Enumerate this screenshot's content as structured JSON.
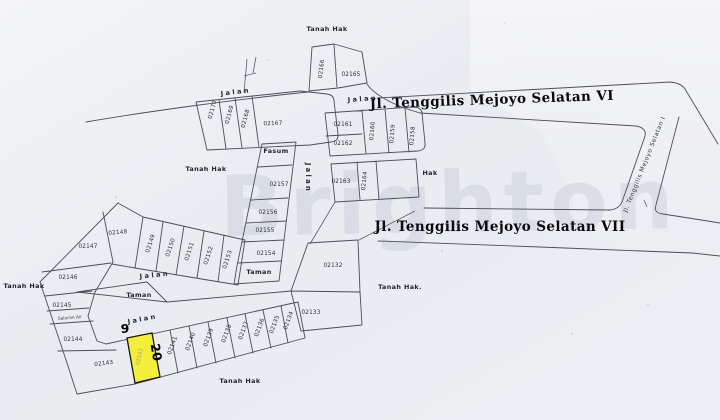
{
  "map": {
    "kind": "cadastral-parcel-map",
    "watermark": "Brighton",
    "highlight": {
      "parcel": "02142",
      "frontage": "9",
      "depth": "20",
      "fill": "#f3ee3b"
    },
    "streets": {
      "selatan_vi": "Jl. Tenggilis Mejoyo Selatan VI",
      "selatan_vii": "Jl. Tenggilis Mejoyo Selatan VII",
      "selatan_i": "Jl. Tenggilis Mejoyo Selatan I"
    },
    "labels": [
      {
        "t": "Jl. Tenggilis Mejoyo Selatan VI",
        "x": 492,
        "y": 104,
        "r": -2,
        "c": "street"
      },
      {
        "t": "Jl. Tenggilis Mejoyo Selatan VII",
        "x": 500,
        "y": 231,
        "r": 0,
        "c": "street"
      },
      {
        "t": "Jl. Tenggilis Mejoyo Selatan I",
        "x": 646,
        "y": 165,
        "r": -68,
        "c": "street-sm"
      },
      {
        "t": "Jalan",
        "x": 236,
        "y": 94,
        "r": -7,
        "c": "road"
      },
      {
        "t": "Jalan",
        "x": 363,
        "y": 101,
        "r": -4,
        "c": "road"
      },
      {
        "t": "Jalan",
        "x": 306,
        "y": 178,
        "r": 90,
        "c": "road"
      },
      {
        "t": "Jalan",
        "x": 155,
        "y": 277,
        "r": -6,
        "c": "road"
      },
      {
        "t": "Jalan",
        "x": 143,
        "y": 321,
        "r": -11,
        "c": "road"
      },
      {
        "t": "Tanah Hak",
        "x": 327,
        "y": 31,
        "r": 0,
        "c": "area"
      },
      {
        "t": "Tanah Hak",
        "x": 206,
        "y": 171,
        "r": 0,
        "c": "area"
      },
      {
        "t": "Tanah Hak",
        "x": 24,
        "y": 288,
        "r": 0,
        "c": "area"
      },
      {
        "t": "Tanah Hak",
        "x": 240,
        "y": 383,
        "r": 0,
        "c": "area"
      },
      {
        "t": "Tanah Hak.",
        "x": 400,
        "y": 289,
        "r": 0,
        "c": "area"
      },
      {
        "t": "Hak",
        "x": 430,
        "y": 175,
        "r": 0,
        "c": "area"
      },
      {
        "t": "Taman",
        "x": 259,
        "y": 274,
        "r": 0,
        "c": "area"
      },
      {
        "t": "Taman",
        "x": 139,
        "y": 297,
        "r": 0,
        "c": "area"
      },
      {
        "t": "Fasum",
        "x": 276,
        "y": 153,
        "r": 0,
        "c": "area"
      },
      {
        "t": "Saluran Air",
        "x": 70,
        "y": 319,
        "r": -4,
        "c": "tiny"
      },
      {
        "t": "02165",
        "x": 351,
        "y": 76,
        "r": 0,
        "c": "parcel"
      },
      {
        "t": "02166",
        "x": 323,
        "y": 69,
        "r": -83,
        "c": "parcel"
      },
      {
        "t": "02170",
        "x": 214,
        "y": 110,
        "r": -75,
        "c": "parcel"
      },
      {
        "t": "02169",
        "x": 231,
        "y": 115,
        "r": -75,
        "c": "parcel"
      },
      {
        "t": "02168",
        "x": 247,
        "y": 119,
        "r": -75,
        "c": "parcel"
      },
      {
        "t": "02167",
        "x": 273,
        "y": 125,
        "r": -2,
        "c": "parcel"
      },
      {
        "t": "02157",
        "x": 279,
        "y": 186,
        "r": 0,
        "c": "parcel"
      },
      {
        "t": "02156",
        "x": 268,
        "y": 214,
        "r": 0,
        "c": "parcel"
      },
      {
        "t": "02155",
        "x": 265,
        "y": 232,
        "r": 0,
        "c": "parcel"
      },
      {
        "t": "02154",
        "x": 266,
        "y": 255,
        "r": 0,
        "c": "parcel"
      },
      {
        "t": "02161",
        "x": 343,
        "y": 126,
        "r": 0,
        "c": "parcel"
      },
      {
        "t": "02162",
        "x": 343,
        "y": 145,
        "r": 0,
        "c": "parcel"
      },
      {
        "t": "02160",
        "x": 374,
        "y": 131,
        "r": -85,
        "c": "parcel"
      },
      {
        "t": "02159",
        "x": 394,
        "y": 134,
        "r": -85,
        "c": "parcel"
      },
      {
        "t": "02158",
        "x": 414,
        "y": 136,
        "r": -85,
        "c": "parcel"
      },
      {
        "t": "02163",
        "x": 341,
        "y": 183,
        "r": 0,
        "c": "parcel"
      },
      {
        "t": "02164",
        "x": 366,
        "y": 181,
        "r": -85,
        "c": "parcel"
      },
      {
        "t": "02132",
        "x": 333,
        "y": 267,
        "r": 0,
        "c": "parcel"
      },
      {
        "t": "02133",
        "x": 311,
        "y": 314,
        "r": 0,
        "c": "parcel"
      },
      {
        "t": "02147",
        "x": 88,
        "y": 248,
        "r": 0,
        "c": "parcel"
      },
      {
        "t": "02148",
        "x": 118,
        "y": 234,
        "r": -5,
        "c": "parcel"
      },
      {
        "t": "02149",
        "x": 152,
        "y": 244,
        "r": -72,
        "c": "parcel"
      },
      {
        "t": "02150",
        "x": 172,
        "y": 248,
        "r": -72,
        "c": "parcel"
      },
      {
        "t": "02151",
        "x": 191,
        "y": 252,
        "r": -72,
        "c": "parcel"
      },
      {
        "t": "02152",
        "x": 210,
        "y": 256,
        "r": -72,
        "c": "parcel"
      },
      {
        "t": "02153",
        "x": 229,
        "y": 260,
        "r": -72,
        "c": "parcel"
      },
      {
        "t": "02146",
        "x": 68,
        "y": 279,
        "r": 0,
        "c": "parcel"
      },
      {
        "t": "02145",
        "x": 62,
        "y": 307,
        "r": 0,
        "c": "parcel"
      },
      {
        "t": "02144",
        "x": 73,
        "y": 341,
        "r": 0,
        "c": "parcel"
      },
      {
        "t": "02143",
        "x": 104,
        "y": 365,
        "r": -7,
        "c": "parcel"
      },
      {
        "t": "02141",
        "x": 174,
        "y": 346,
        "r": -70,
        "c": "parcel"
      },
      {
        "t": "02140",
        "x": 192,
        "y": 342,
        "r": -70,
        "c": "parcel"
      },
      {
        "t": "02139",
        "x": 210,
        "y": 338,
        "r": -70,
        "c": "parcel"
      },
      {
        "t": "02138",
        "x": 228,
        "y": 334,
        "r": -70,
        "c": "parcel"
      },
      {
        "t": "02137",
        "x": 245,
        "y": 331,
        "r": -70,
        "c": "parcel"
      },
      {
        "t": "02136",
        "x": 261,
        "y": 328,
        "r": -70,
        "c": "parcel"
      },
      {
        "t": "02135",
        "x": 276,
        "y": 325,
        "r": -70,
        "c": "parcel"
      },
      {
        "t": "02134",
        "x": 290,
        "y": 321,
        "r": -70,
        "c": "parcel"
      },
      {
        "t": "02142",
        "x": 141,
        "y": 357,
        "r": -78,
        "c": "parcel-faint"
      },
      {
        "t": "9",
        "x": 125,
        "y": 333,
        "r": 0,
        "c": "dim"
      },
      {
        "t": "20",
        "x": 152,
        "y": 353,
        "r": 80,
        "c": "dim"
      }
    ]
  }
}
